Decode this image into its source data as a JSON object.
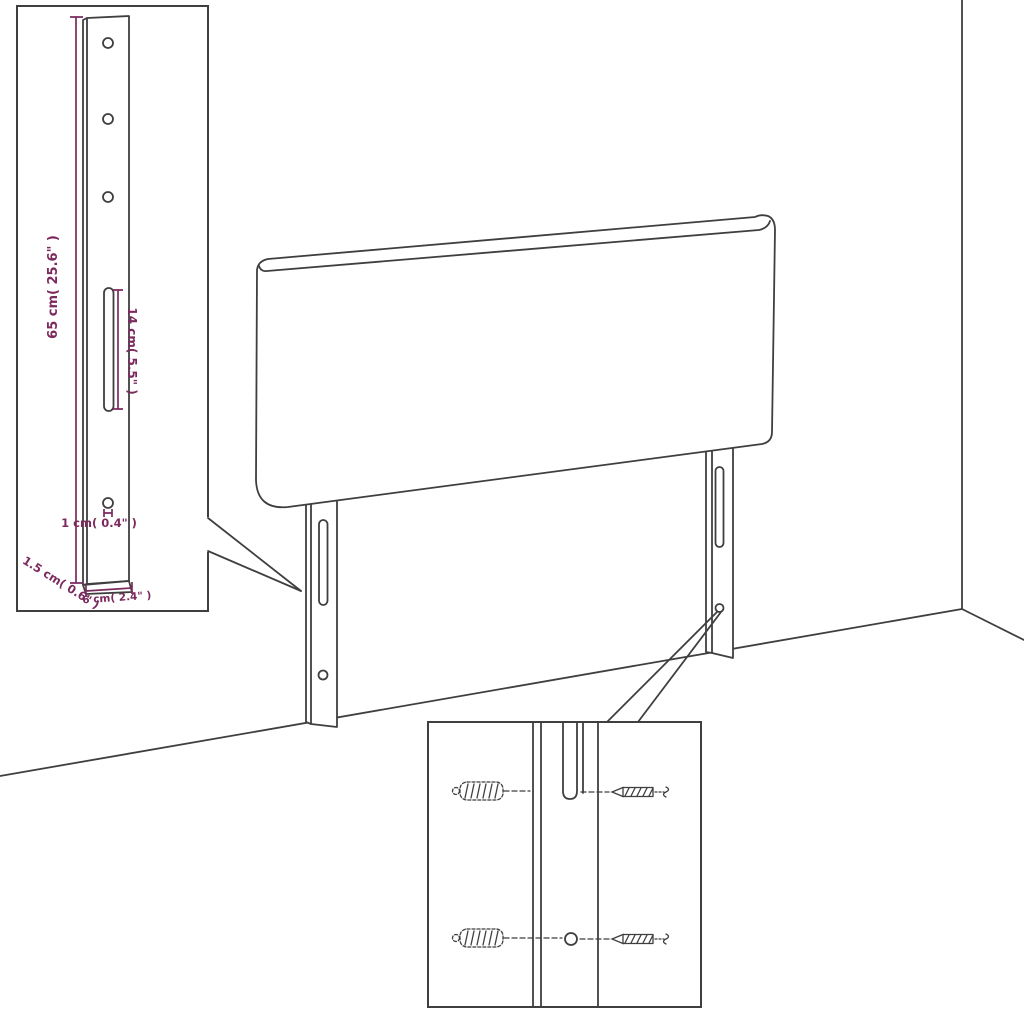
{
  "title": "Headboard mounting-bracket dimension diagram",
  "colors": {
    "dimension": "#7c2a5e",
    "line": "#3f3f3f",
    "background": "#ffffff"
  },
  "dimensions": {
    "bracket_height": "65 cm( 25.6\" )",
    "slot_length": "14 cm( 5.5\" )",
    "hole_diameter": "1 cm( 0.4\" )",
    "bracket_depth": "1.5 cm( 0.6\" )",
    "bracket_width": "6 cm( 2.4\" )"
  }
}
